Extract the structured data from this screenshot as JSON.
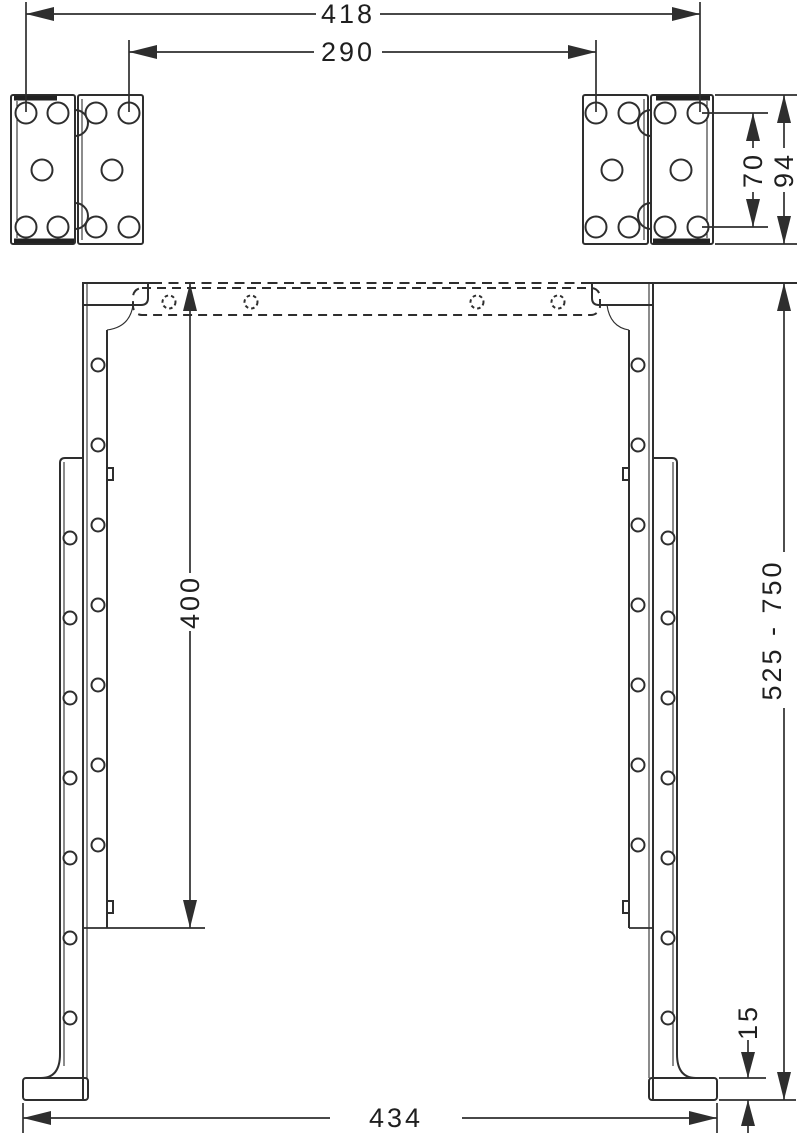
{
  "drawing": {
    "background": "#ffffff",
    "line_color": "#2e2e2e",
    "text_color": "#1f1f1f",
    "dimensions": {
      "outer_hole_span": "418",
      "inner_hole_span": "290",
      "bracket_hole_spacing": "70",
      "bracket_height": "94",
      "inner_rail_length": "400",
      "adjustable_height_range": "525 - 750",
      "foot_height": "15",
      "base_width": "434"
    }
  }
}
